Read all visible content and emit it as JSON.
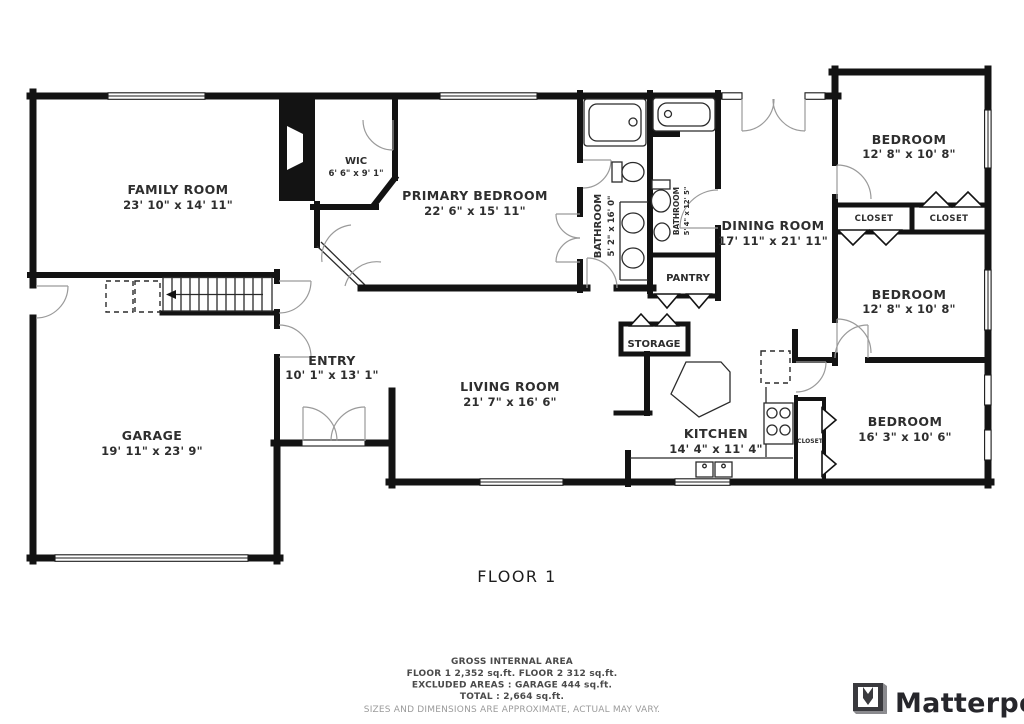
{
  "floor_label": "FLOOR 1",
  "rooms": {
    "family_room": {
      "name": "FAMILY ROOM",
      "dims": "23' 10\" x 14' 11\""
    },
    "wic": {
      "name": "WIC",
      "dims": "6' 6\" x 9' 1\""
    },
    "primary_bedroom": {
      "name": "PRIMARY BEDROOM",
      "dims": "22' 6\" x 15' 11\""
    },
    "bathroom_primary": {
      "name": "BATHROOM",
      "dims": "5' 2\" x 16' 0\""
    },
    "bathroom_hall": {
      "name": "BATHROOM",
      "dims": "5' 4\" x 12' 5\""
    },
    "pantry": {
      "name": "PANTRY"
    },
    "dining_room": {
      "name": "DINING ROOM",
      "dims": "17' 11\" x 21' 11\""
    },
    "bedroom_top_right": {
      "name": "BEDROOM",
      "dims": "12' 8\" x 10' 8\""
    },
    "closet_left": {
      "name": "CLOSET"
    },
    "closet_right": {
      "name": "CLOSET"
    },
    "bedroom_middle_right": {
      "name": "BEDROOM",
      "dims": "12' 8\" x 10' 8\""
    },
    "storage": {
      "name": "STORAGE"
    },
    "living_room": {
      "name": "LIVING ROOM",
      "dims": "21' 7\" x 16' 6\""
    },
    "kitchen": {
      "name": "KITCHEN",
      "dims": "14' 4\" x 11' 4\""
    },
    "closet_hall": {
      "name": "CLOSET"
    },
    "bedroom_bottom_right": {
      "name": "BEDROOM",
      "dims": "16' 3\" x 10' 6\""
    },
    "garage": {
      "name": "GARAGE",
      "dims": "19' 11\" x 23' 9\""
    },
    "entry": {
      "name": "ENTRY",
      "dims": "10' 1\" x 13' 1\""
    }
  },
  "footer": {
    "heading": "GROSS INTERNAL AREA",
    "line1": "FLOOR 1 2,352 sq.ft.    FLOOR 2 312 sq.ft.",
    "line2": "EXCLUDED AREAS :   GARAGE 444 sq.ft.",
    "line3": "TOTAL :  2,664 sq.ft.",
    "disclaimer": "SIZES AND DIMENSIONS ARE APPROXIMATE, ACTUAL MAY VARY."
  },
  "brand": {
    "name": "Matterport"
  },
  "colors": {
    "wall": "#131313",
    "label": "#2e2e2e",
    "footer_text": "#4a4a4a",
    "disclaimer": "#9b9b9b",
    "brand": "#26262b",
    "background": "#ffffff"
  }
}
